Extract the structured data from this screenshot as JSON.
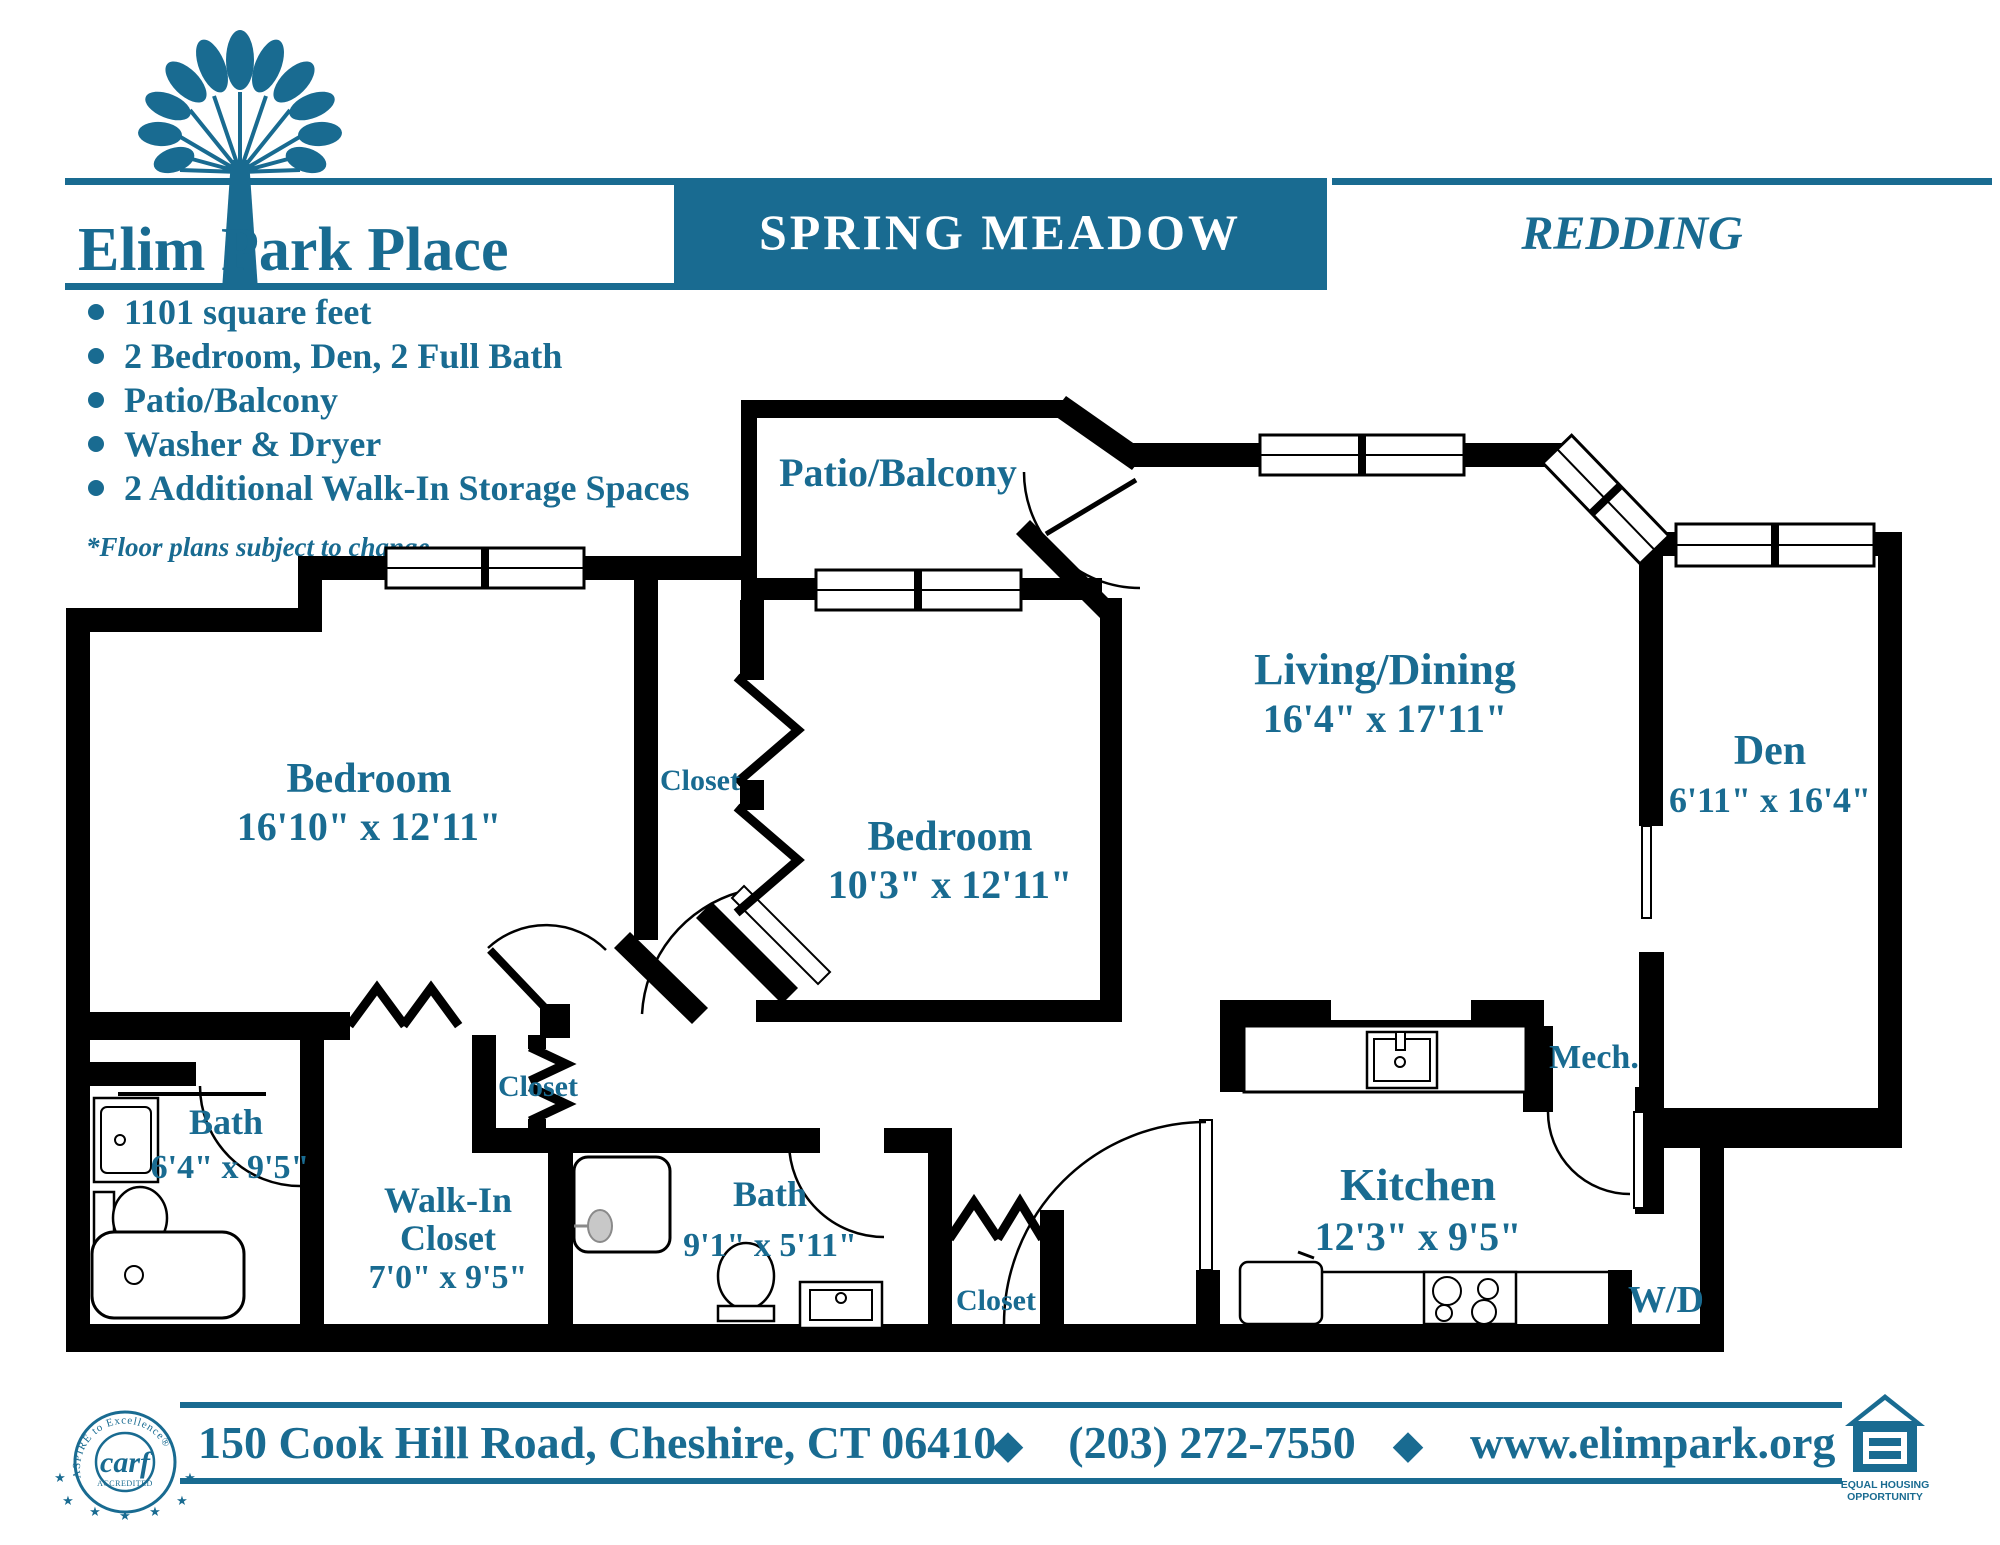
{
  "colors": {
    "teal": "#196b91",
    "wall": "#000000",
    "paper": "#ffffff"
  },
  "header": {
    "logo_title": "Elim Park Place",
    "banner_title": "SPRING MEADOW",
    "unit_name": "REDDING"
  },
  "features": {
    "items": [
      "1101 square feet",
      "2 Bedroom, Den, 2 Full Bath",
      "Patio/Balcony",
      "Washer & Dryer",
      "2 Additional Walk-In Storage Spaces"
    ],
    "disclaimer": "*Floor plans subject to change"
  },
  "floorplan": {
    "patio_label": "Patio/Balcony",
    "bedroom1": {
      "name": "Bedroom",
      "dims": "16'10\" x 12'11\""
    },
    "bedroom2": {
      "name": "Bedroom",
      "dims": "10'3\" x 12'11\""
    },
    "living": {
      "name": "Living/Dining",
      "dims": "16'4\" x 17'11\""
    },
    "den": {
      "name": "Den",
      "dims": "6'11\" x 16'4\""
    },
    "bath1": {
      "name": "Bath",
      "dims": "6'4\" x 9'5\""
    },
    "walkin": {
      "line1": "Walk-In",
      "line2": "Closet",
      "dims": "7'0\" x 9'5\""
    },
    "bath2": {
      "name": "Bath",
      "dims": "9'1\" x 5'11\""
    },
    "kitchen": {
      "name": "Kitchen",
      "dims": "12'3\" x 9'5\""
    },
    "mech_label": "Mech.",
    "wd_label": "W/D",
    "closet_bedroom2": "Closet",
    "closet_hall": "Closet",
    "closet_bath2": "Closet"
  },
  "footer": {
    "address": "150 Cook Hill Road, Cheshire, CT 06410",
    "phone": "(203) 272-7550",
    "website": "www.elimpark.org",
    "separator": "◆",
    "carf": {
      "arc_text": "ASPIRE to Excellence®",
      "name": "carf",
      "accredited": "ACCREDITED",
      "star": "★"
    },
    "eho_caption_line1": "EQUAL HOUSING",
    "eho_caption_line2": "OPPORTUNITY"
  }
}
